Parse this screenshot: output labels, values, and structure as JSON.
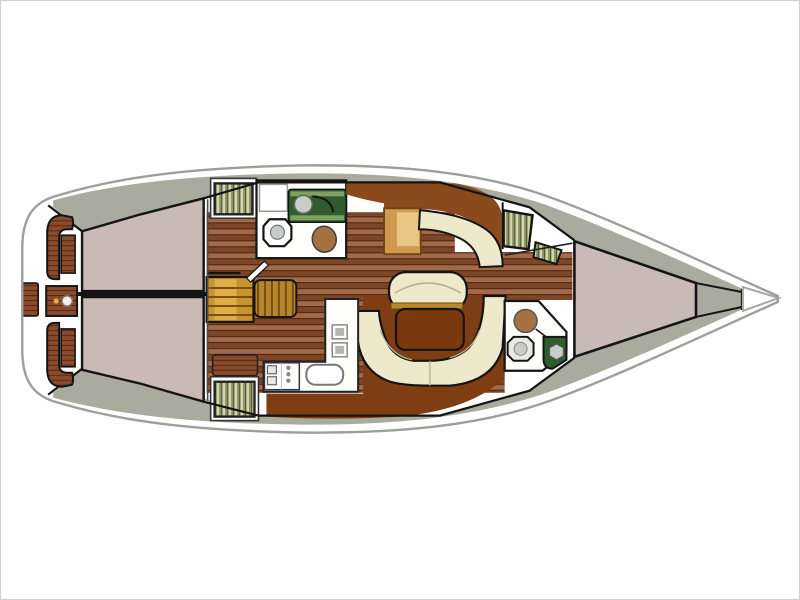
{
  "diagram": {
    "type": "sailboat-interior-floor-plan",
    "orientation": "bow-right-stern-left",
    "rooms": [
      "cockpit",
      "helm-station",
      "transom-step",
      "aft-cabin-port-berth",
      "aft-cabin-starboard-berth",
      "companionway-steps",
      "saloon-table-unit",
      "aft-head",
      "galley",
      "salon",
      "dinette-u-settee",
      "dinette-table",
      "center-settee",
      "nav-station",
      "nav-settee",
      "chart-table",
      "forward-head",
      "hanging-lockers",
      "v-berth",
      "anchor-locker",
      "aft-locker-port",
      "aft-locker-starboard",
      "side-decks"
    ]
  },
  "colors": {
    "white": "#ffffff",
    "hull_outline": "#9aa09a",
    "deck": "#a9ab9e",
    "outline": "#141414",
    "bulkhead_grey": "#4d4d4d",
    "berth": "#c9bab5",
    "floor_light": "#a2694a",
    "floor_dark": "#7c4628",
    "floor_seam": "#55290f",
    "bench_teak": "#8a4a2c",
    "bench_streak": "#5a2a14",
    "settee": "#eee9cb",
    "settee_seam": "#b8b28c",
    "table": "#7a390d",
    "sole": "#7e3d12",
    "nav_brown": "#8a4a1c",
    "chart_tan": "#cf9a4e",
    "chart_top": "#e9c684",
    "steps": "#c9942e",
    "steps_light": "#e0ae46",
    "steps_tread": "#7a5210",
    "slat_base": "#b8862a",
    "slat_dark": "#6f4a10",
    "stripe_base": "#d7d3a8",
    "stripe_green": "#6f7a4e",
    "stripe_dark": "#40502f",
    "head_green": "#2e5c2e",
    "head_green_light": "#80a05e",
    "fixture_grey": "#c9cdc9",
    "toilet_fill": "#e9e9e4",
    "basin": "#a5713f",
    "gold_trim": "#b98a28",
    "wheel": "#f0f0ec",
    "counter_white": "#fdfdfa",
    "room_white": "#fefefc"
  }
}
